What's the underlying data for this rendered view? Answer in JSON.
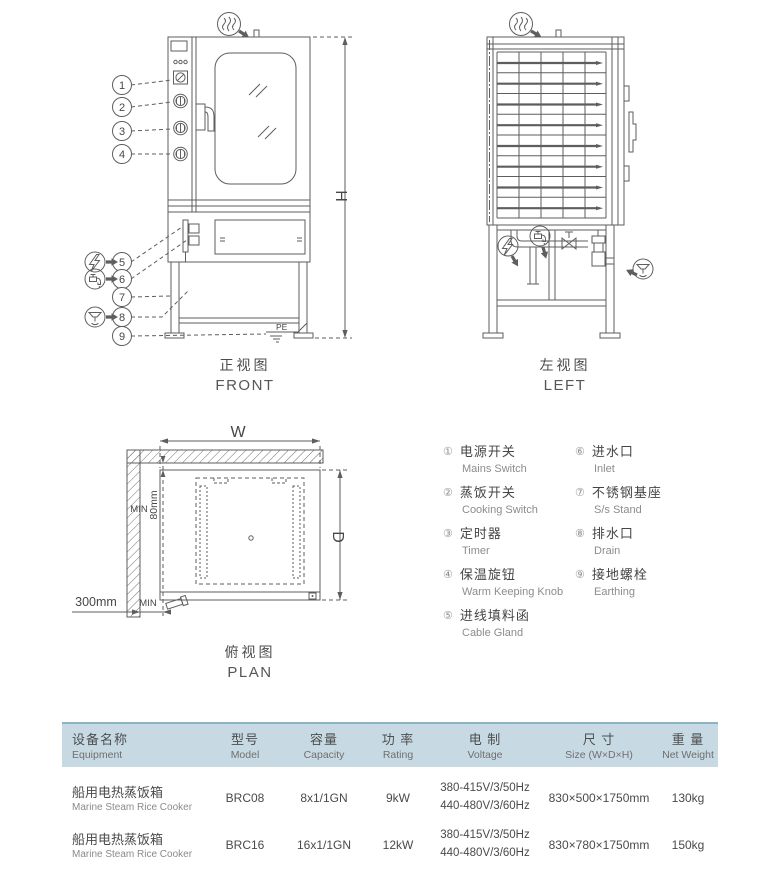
{
  "drawings": {
    "front": {
      "title_zh": "正视图",
      "title_en": "FRONT",
      "dim_h": "H",
      "pe": "PE",
      "callouts": [
        "1",
        "2",
        "3",
        "4",
        "5",
        "6",
        "7",
        "8",
        "9"
      ]
    },
    "left": {
      "title_zh": "左视图",
      "title_en": "LEFT"
    },
    "plan": {
      "title_zh": "俯视图",
      "title_en": "PLAN",
      "dim_w": "W",
      "dim_d": "D",
      "min_top": "MIN",
      "dim_80": "80mm",
      "min_bottom": "MIN",
      "dim_300": "300mm"
    }
  },
  "legend": {
    "items": [
      {
        "num": "①",
        "zh": "电源开关",
        "en": "Mains Switch"
      },
      {
        "num": "②",
        "zh": "蒸饭开关",
        "en": "Cooking Switch"
      },
      {
        "num": "③",
        "zh": "定时器",
        "en": "Timer"
      },
      {
        "num": "④",
        "zh": "保温旋钮",
        "en": "Warm Keeping Knob"
      },
      {
        "num": "⑤",
        "zh": "进线填料函",
        "en": "Cable Gland"
      },
      {
        "num": "⑥",
        "zh": "进水口",
        "en": "Inlet"
      },
      {
        "num": "⑦",
        "zh": "不锈钢基座",
        "en": "S/s Stand"
      },
      {
        "num": "⑧",
        "zh": "排水口",
        "en": "Drain"
      },
      {
        "num": "⑨",
        "zh": "接地螺栓",
        "en": "Earthing"
      }
    ]
  },
  "table": {
    "headers": [
      {
        "zh": "设备名称",
        "en": "Equipment"
      },
      {
        "zh": "型号",
        "en": "Model"
      },
      {
        "zh": "容量",
        "en": "Capacity"
      },
      {
        "zh": "功 率",
        "en": "Rating"
      },
      {
        "zh": "电 制",
        "en": "Voltage"
      },
      {
        "zh": "尺 寸",
        "en": "Size (W×D×H)"
      },
      {
        "zh": "重 量",
        "en": "Net Weight"
      }
    ],
    "rows": [
      {
        "equipment_zh": "船用电热蒸饭箱",
        "equipment_en": "Marine Steam Rice Cooker",
        "model": "BRC08",
        "capacity": "8x1/1GN",
        "rating": "9kW",
        "voltage1": "380-415V/3/50Hz",
        "voltage2": "440-480V/3/60Hz",
        "size": "830×500×1750mm",
        "weight": "130kg"
      },
      {
        "equipment_zh": "船用电热蒸饭箱",
        "equipment_en": "Marine Steam Rice Cooker",
        "model": "BRC16",
        "capacity": "16x1/1GN",
        "rating": "12kW",
        "voltage1": "380-415V/3/50Hz",
        "voltage2": "440-480V/3/60Hz",
        "size": "830×780×1750mm",
        "weight": "150kg"
      }
    ]
  },
  "colors": {
    "line": "#5e5e5e",
    "table_header_bg": "#c7d9e3",
    "table_header_line": "#8fb3c6",
    "text_dark": "#474747",
    "text_gray": "#8a8a8a"
  }
}
